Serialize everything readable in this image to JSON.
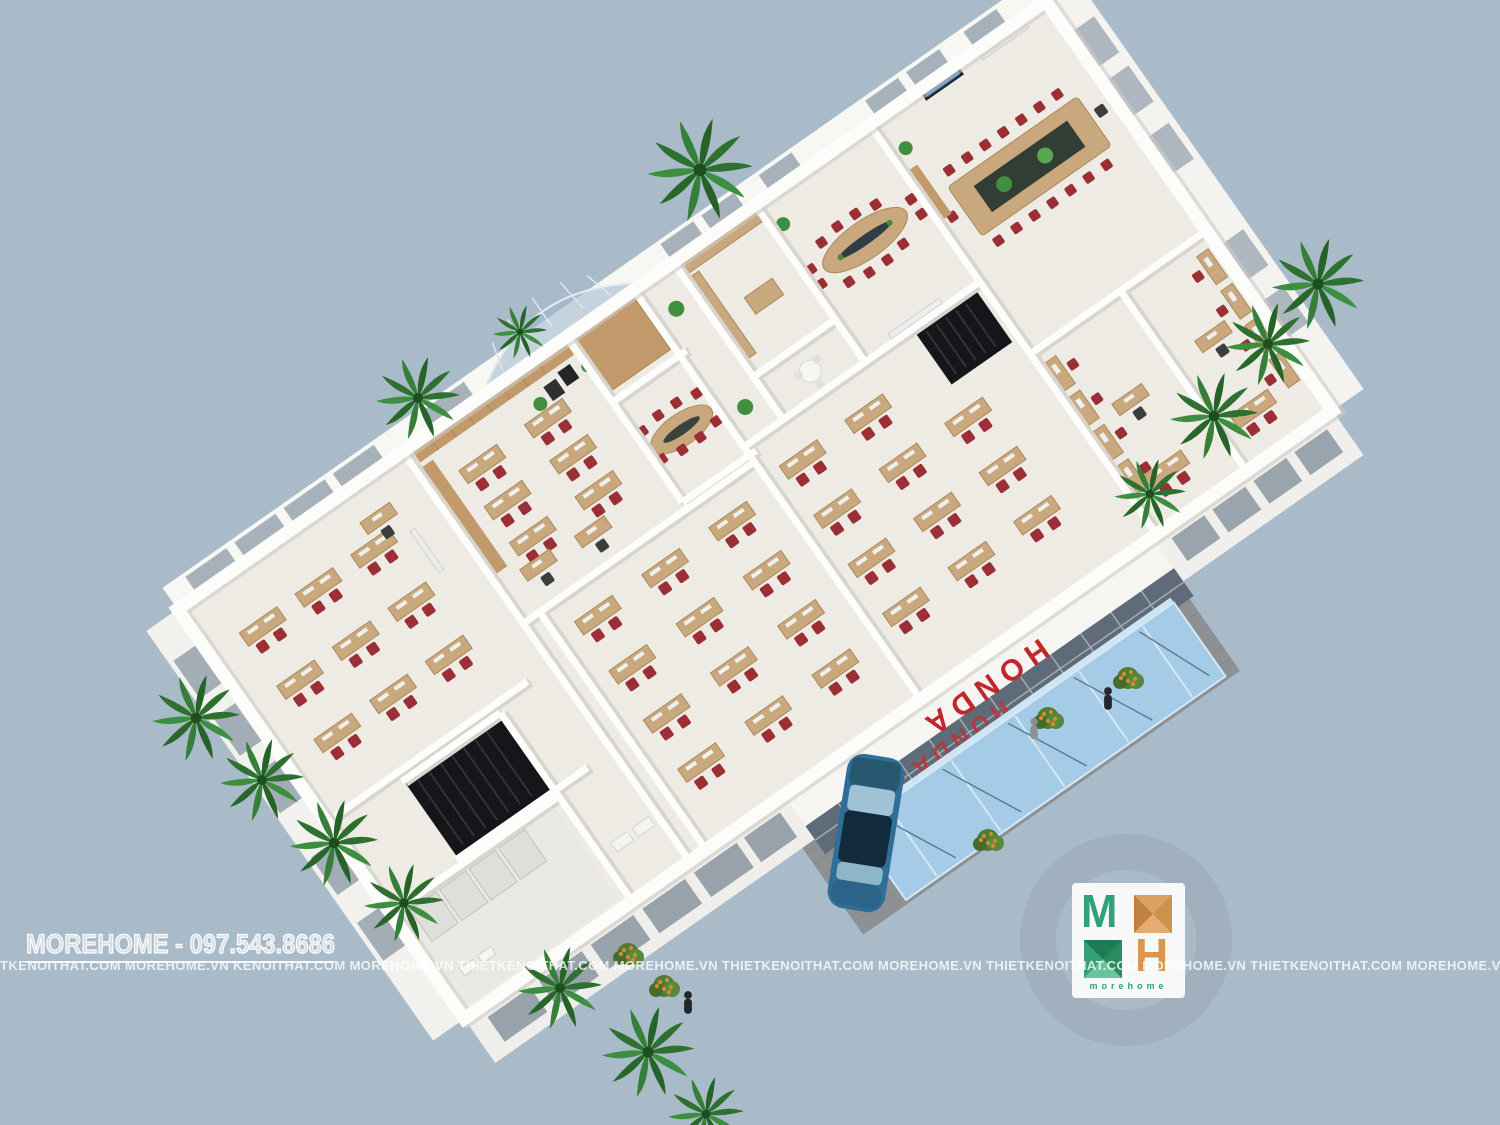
{
  "scene_type": "3d-isometric-office-floorplan-render",
  "branding": {
    "watermark_title": "MOREHOME - 097.543.8686",
    "watermark_strip": "TKENOITHAT.COM MOREHOME.VN  KENOITHAT.COM MOREHOME.VN  THIETKENOITHAT.COM MOREHOME.VN  THIETKENOITHAT.COM MOREHOME.VN  THIETKENOITHAT.COM MOREHOME.VN  THIETKENOITHAT.COM MOREHOME.VN  THIETKENOITHAT.COM MOREHOME.VN  THIETKENOITHAT.COM MOREHOME.VN  THIETKENOITHAT.COM MOREHOME.VN",
    "logo": {
      "letter_m": "M",
      "letter_h": "H",
      "wordmark": "morehome"
    }
  },
  "building": {
    "sign_upper": "HONDA",
    "sign_lower": "HONDA"
  },
  "colors": {
    "background": "#a9bac9",
    "honda_red": "#c0272d",
    "canopy_blue": "#a6cde9",
    "chair_red": "#9c2f35",
    "desk_wood": "#c8a87c",
    "palm_green": "#2f7a35",
    "logo_green": "#2fa27b",
    "logo_orange": "#d8964f"
  }
}
